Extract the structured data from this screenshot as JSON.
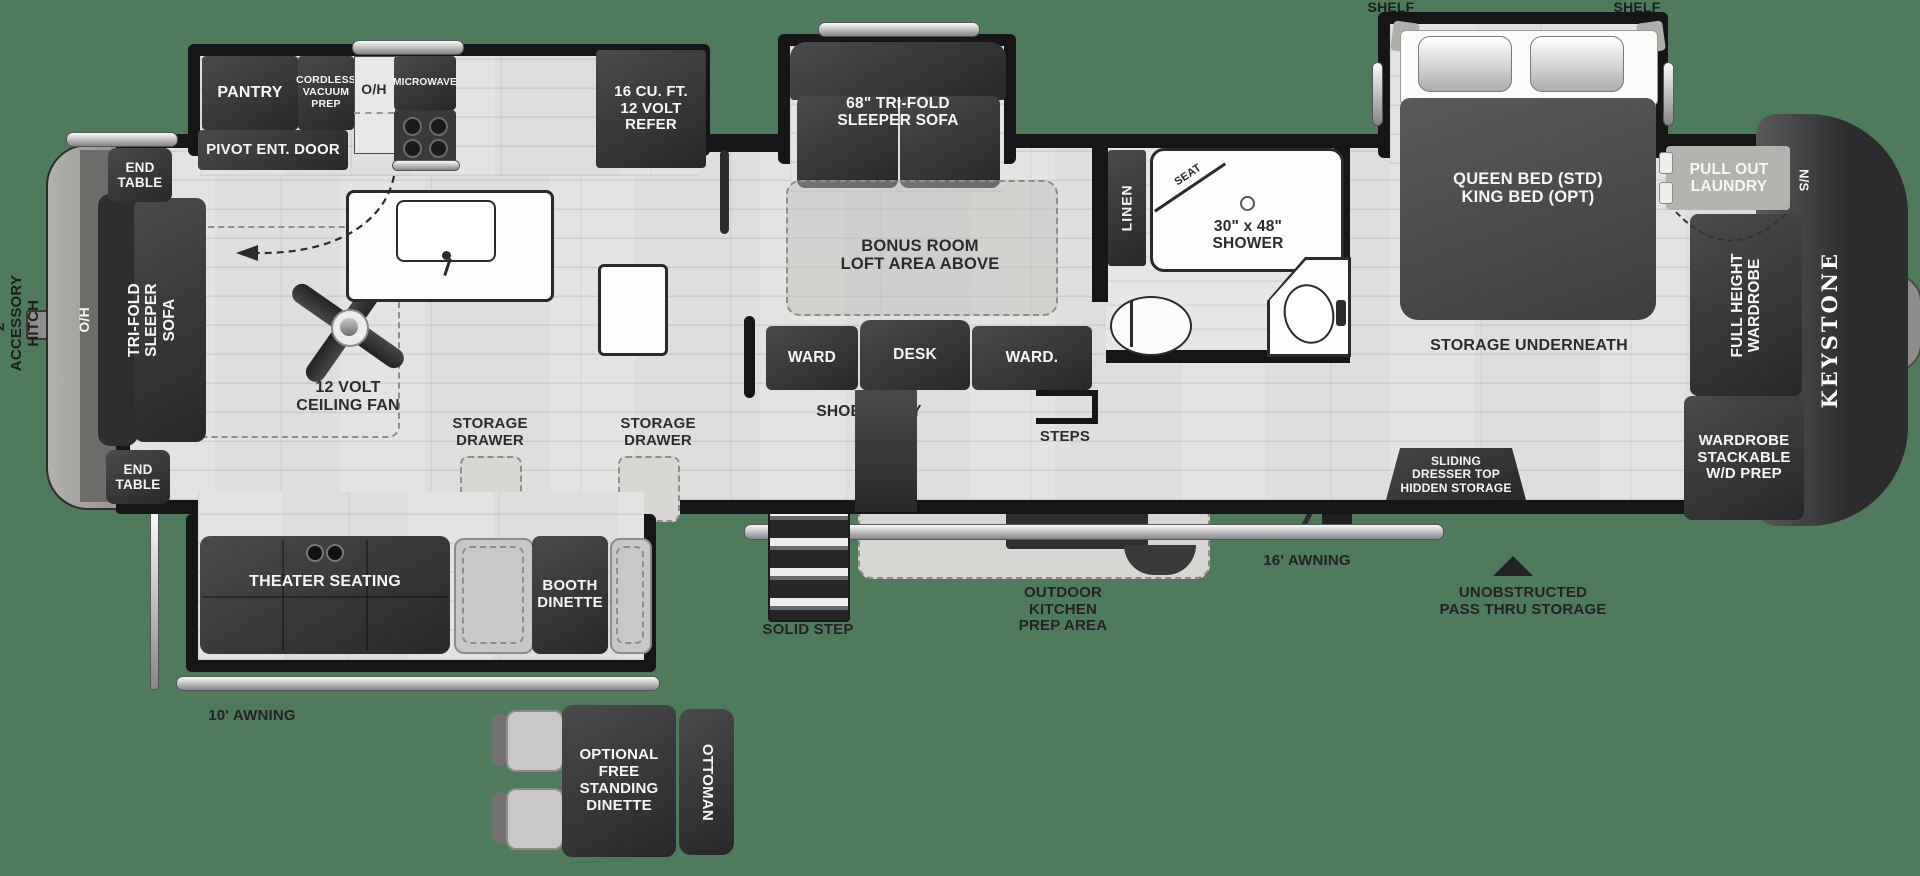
{
  "colors": {
    "background": "#4e7b5c",
    "wall": "#161618",
    "furniture": "#353537",
    "floor": "#dfdedc"
  },
  "exterior": {
    "accessory_hitch": "2\" ACCESSORY HITCH",
    "awning_rear": "10' AWNING",
    "awning_front": "16' AWNING",
    "solid_step": "SOLID STEP",
    "outdoor_kitchen": "OUTDOOR\nKITCHEN\nPREP AREA",
    "pass_thru": "UNOBSTRUCTED\nPASS THRU STORAGE",
    "shelf_left": "SHELF",
    "shelf_right": "SHELF",
    "brand": "KEYSTONE"
  },
  "kitchen": {
    "pantry": "PANTRY",
    "cordless_vacuum": "CORDLESS\nVACUUM\nPREP",
    "overhead": "O/H",
    "microwave": "MICROWAVE",
    "refrigerator": "16 CU. FT.\n12 VOLT\nREFER",
    "entry_door": "PIVOT ENT. DOOR"
  },
  "living": {
    "end_table_top": "END\nTABLE",
    "end_table_bottom": "END\nTABLE",
    "rear_overhead": "O/H",
    "rear_sofa": "TRI-FOLD\nSLEEPER SOFA",
    "ceiling_fan": "12 VOLT\nCEILING FAN",
    "theater_seating": "THEATER SEATING",
    "booth_dinette": "BOOTH\nDINETTE",
    "storage_drawer_left": "STORAGE\nDRAWER",
    "storage_drawer_right": "STORAGE\nDRAWER"
  },
  "mid": {
    "sleeper_sofa": "68\" TRI-FOLD\nSLEEPER SOFA",
    "bonus_room": "BONUS ROOM\nLOFT AREA ABOVE",
    "ward_left": "WARD",
    "desk": "DESK",
    "ward_right": "WARD.",
    "shoe_cubby": "SHOE CUBBY",
    "steps": "STEPS"
  },
  "bathroom": {
    "linen": "LINEN",
    "seat": "SEAT",
    "shower": "30\" x 48\"\nSHOWER"
  },
  "bedroom": {
    "bed": "QUEEN BED (STD)\nKING BED (OPT)",
    "storage_underneath": "STORAGE UNDERNEATH",
    "sliding_dresser": "SLIDING\nDRESSER TOP\nHIDDEN STORAGE",
    "laundry": "PULL OUT\nLAUNDRY",
    "nightstand": "N/S",
    "full_height_wardrobe": "FULL HEIGHT\nWARDROBE",
    "wardrobe_stackable": "WARDROBE\nSTACKABLE\nW/D PREP"
  },
  "optional_dinette": {
    "table": "OPTIONAL\nFREE\nSTANDING\nDINETTE",
    "ottoman": "OTTOMAN"
  }
}
